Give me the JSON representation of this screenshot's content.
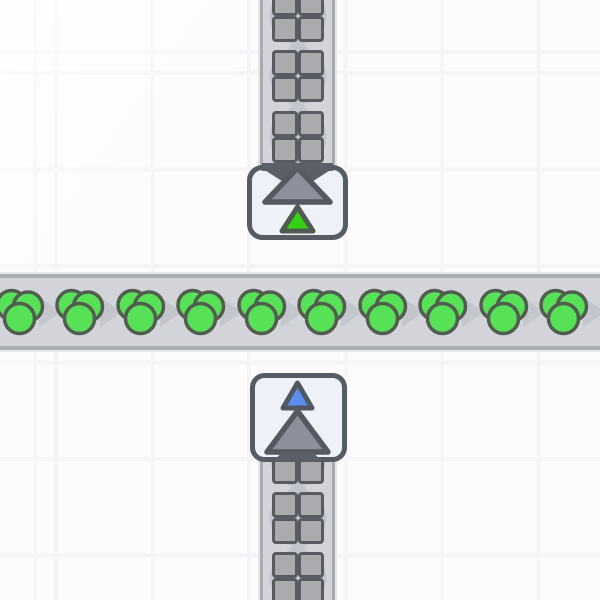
{
  "scene": {
    "background": "#fcfcfd",
    "grid": {
      "line_color": "#f4f5f7",
      "spacing": 96.5,
      "line_width": 4,
      "offset_x": 54,
      "offset_y": 71
    },
    "colors": {
      "belt_body": "#d2d4d9",
      "belt_edge": "#a9acb3",
      "chevron": "#c3c6cc",
      "building_fill": "#eef1f7",
      "building_border": "#565b64",
      "arrow_fill": "#8b909a",
      "arrow_stroke": "#545962",
      "dark_mouth": "#5a5f68",
      "marker_green": "#35d011",
      "marker_green_stroke": "#4f5a50",
      "marker_blue": "#5b8cf0",
      "marker_blue_stroke": "#525862",
      "item_green": "#57e157",
      "item_green_stroke": "#535c50",
      "shape_gray": "#a9abae",
      "shape_stroke": "#585b61",
      "shape_disc": "#c2c5cb"
    },
    "belts": [
      {
        "id": "belt-horizontal",
        "name": "conveyor-belt-horizontal",
        "x": 0,
        "y": 274,
        "w": 600,
        "h": 76,
        "direction": "right",
        "chevrons": [
          {
            "x": 50,
            "y": 312
          },
          {
            "x": 111,
            "y": 312
          },
          {
            "x": 171,
            "y": 312
          },
          {
            "x": 231,
            "y": 312
          },
          {
            "x": 292,
            "y": 312
          },
          {
            "x": 352,
            "y": 312
          },
          {
            "x": 413,
            "y": 312
          },
          {
            "x": 473,
            "y": 312
          },
          {
            "x": 534,
            "y": 312
          },
          {
            "x": 594,
            "y": 312
          }
        ],
        "items": [
          {
            "x": 20,
            "y": 312
          },
          {
            "x": 80,
            "y": 312
          },
          {
            "x": 141,
            "y": 312
          },
          {
            "x": 201,
            "y": 312
          },
          {
            "x": 262,
            "y": 312
          },
          {
            "x": 322,
            "y": 312
          },
          {
            "x": 383,
            "y": 312
          },
          {
            "x": 443,
            "y": 312
          },
          {
            "x": 504,
            "y": 312
          },
          {
            "x": 564,
            "y": 312
          }
        ],
        "item_type": "green-color-item"
      },
      {
        "id": "belt-vertical-top",
        "name": "conveyor-belt-vertical-top",
        "x": 260,
        "y": 0,
        "w": 75,
        "h": 170,
        "direction": "up",
        "chevrons": [
          {
            "x": 297.5,
            "y": 45.5
          },
          {
            "x": 297.5,
            "y": 106.5
          }
        ],
        "items": [
          {
            "x": 297.5,
            "y": 16
          },
          {
            "x": 297.5,
            "y": 76
          },
          {
            "x": 297.5,
            "y": 137
          }
        ],
        "item_type": "gray-square-shape"
      },
      {
        "id": "belt-vertical-bottom",
        "name": "conveyor-belt-vertical-bottom",
        "x": 260,
        "y": 455,
        "w": 75,
        "h": 145,
        "direction": "up",
        "chevrons": [
          {
            "x": 297.5,
            "y": 488
          },
          {
            "x": 297.5,
            "y": 548
          }
        ],
        "items": [
          {
            "x": 297.5,
            "y": 458
          },
          {
            "x": 297.5,
            "y": 518
          },
          {
            "x": 297.5,
            "y": 578
          }
        ],
        "item_type": "gray-square-shape"
      }
    ],
    "buildings": [
      {
        "id": "tunnel-exit",
        "name": "underground-belt-exit",
        "x": 243,
        "y": 161,
        "svg_w": 110,
        "svg_h": 90,
        "rect": {
          "x": 6.5,
          "y": 6.5,
          "w": 96,
          "h": 70,
          "rx": 13
        },
        "center_x": 54.5,
        "variant": "exit",
        "marker": "green",
        "arrow_direction": "up"
      },
      {
        "id": "tunnel-entrance",
        "name": "underground-belt-entrance",
        "x": 246,
        "y": 370,
        "svg_w": 105,
        "svg_h": 100,
        "rect": {
          "x": 6.5,
          "y": 5.5,
          "w": 92,
          "h": 84,
          "rx": 12
        },
        "center_x": 51.5,
        "variant": "entrance",
        "marker": "blue",
        "arrow_direction": "up"
      }
    ]
  }
}
